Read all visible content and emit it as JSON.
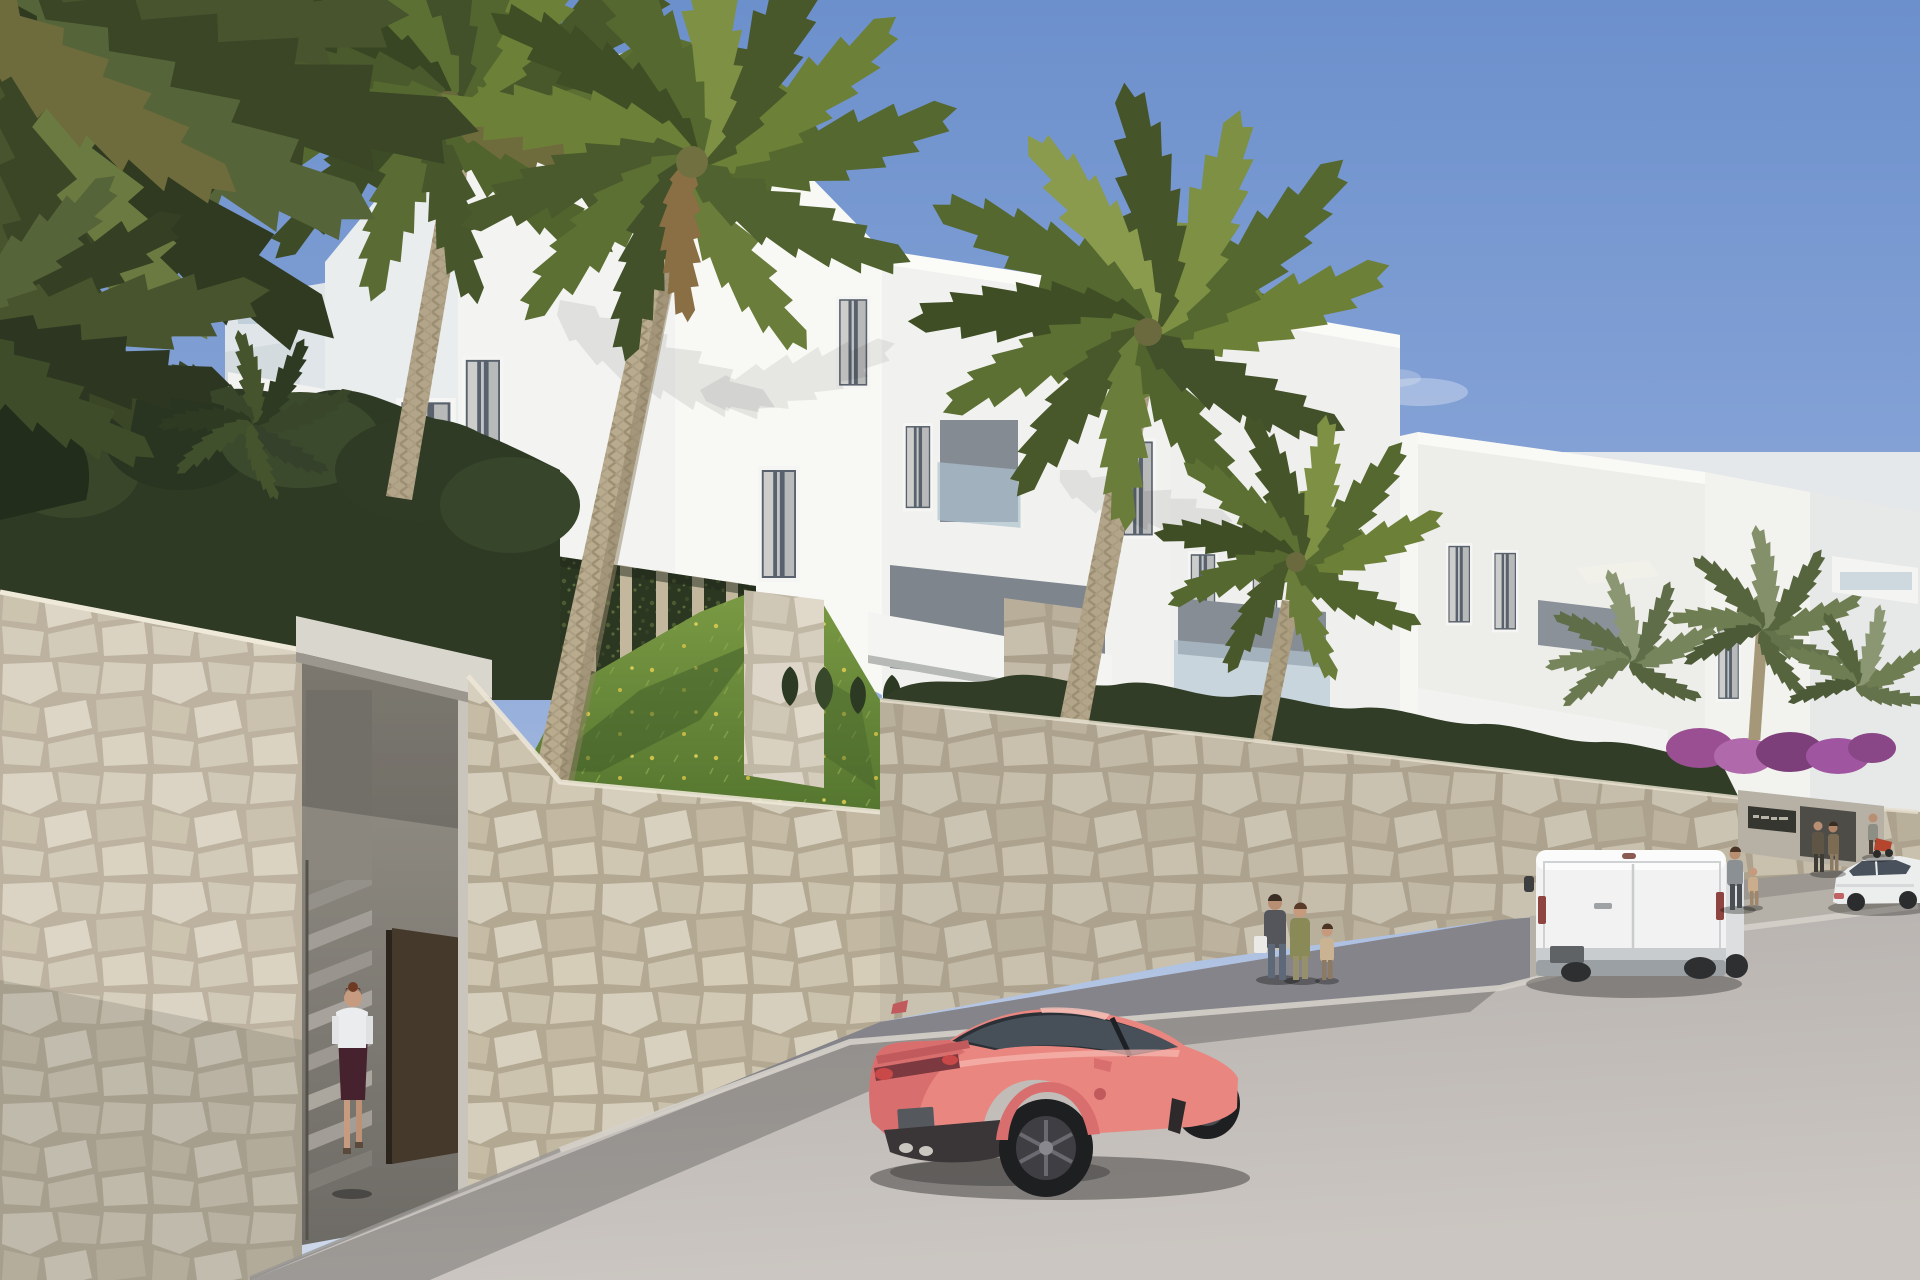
{
  "scene": {
    "description": "Sunny architectural rendering of a white Mediterranean apartment complex on a hillside street, with tall fan palms, a cream stone retaining wall with a pedestrian entrance and stairs, a woman walking in, a coral sports car and a white van parked on the road, a white sedan and pedestrians near the residence entrance, hedges, ivy walls, a grass slope and bougainvillea under a clear blue sky",
    "objects": [
      "apartment-buildings",
      "rooftop-parasol",
      "rooftop-tree",
      "palm-trees",
      "overhanging-palm-fronds",
      "stone-retaining-wall",
      "garden-entrance",
      "entrance-stairs",
      "entrance-door",
      "woman-walking",
      "ivy-wall",
      "hedge",
      "grass-slope",
      "bougainvillea",
      "residence-sign",
      "coral-sports-car",
      "white-van",
      "white-sedan",
      "moped-with-rider",
      "family-pedestrians",
      "man-with-child",
      "couple",
      "street",
      "sidewalk",
      "curb",
      "wispy-cloud"
    ]
  },
  "colors": {
    "sky_top": "#6c90cc",
    "sky_mid": "#8aa6d8",
    "sky_horizon": "#cfdaeb",
    "building_sunlit": "#f8f8f5",
    "building_shade": "#e9edee",
    "building_dim": "#eff0ed",
    "stone_grout": "#b3a892",
    "stone_light": "#d7cfbd",
    "hedge_dark": "#2e3a24",
    "ivy_dark": "#2c3722",
    "grass_light": "#7a9a44",
    "grass_dark": "#55762f",
    "palm_green": "#6d8038",
    "trunk_tan": "#b3a58a",
    "road_lit": "#c4bfbb",
    "road_shade": "#8f8c8e",
    "sidewalk_shade": "#85848a",
    "car_coral": "#e98680",
    "car_coral_dark": "#d86e6d",
    "van_white": "#f1f2f1",
    "sedan_white": "#eceded",
    "door_brown": "#45392b",
    "sign_dark": "#35362f",
    "bougainvillea": "#9a4f93",
    "umbrella_cream": "#e9e1cd"
  }
}
